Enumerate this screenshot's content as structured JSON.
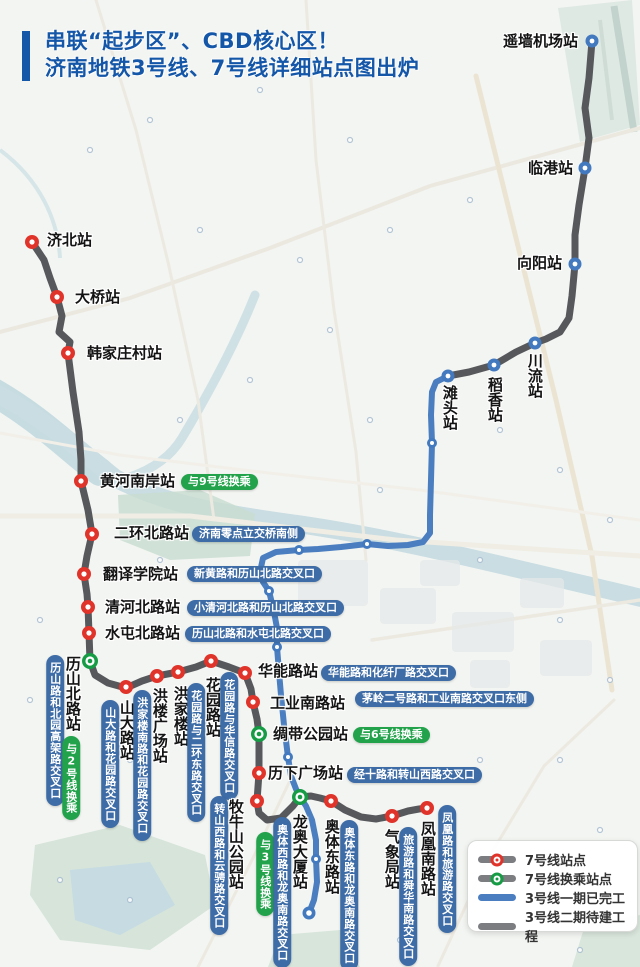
{
  "title": {
    "line1": "串联“起步区”、CBD核心区！",
    "line2": "济南地铁3号线、7号线详细站点图出炉"
  },
  "colors": {
    "title_blue": "#1456A8",
    "badge_blue": "#3E6CA6",
    "badge_green": "#22A24B",
    "line_gray": "#57585C",
    "legend_gray": "#7B7D80",
    "line_blue": "#4A7EC0",
    "dot_red": "#E0342B",
    "dot_green": "#169C44",
    "dot_blue": "#4379BE"
  },
  "legend": {
    "items": [
      {
        "label": "7号线站点",
        "symbol": "line7-station"
      },
      {
        "label": "7号线换乘站点",
        "symbol": "line7-transfer"
      },
      {
        "label": "3号线一期已完工",
        "symbol": "line3-built"
      },
      {
        "label": "3号线二期待建工程",
        "symbol": "line3-planned"
      }
    ]
  },
  "lines": [
    {
      "id": "line3-planned",
      "color": "line_gray",
      "width": 7,
      "points": "592,41 589,78 585,108 589,138 585,168 579,205 575,235 575,264 572,296 569,318 560,332 546,339 535,343 516,352 494,365 469,372 448,376"
    },
    {
      "id": "line3-built",
      "color": "line_blue",
      "width": 6,
      "points": "448,376 436,382 432,392 431,415 432,443 431,480 430,515 430,533 423,542 408,545 388,546 367,544 341,547 318,549 299,550 276,552 263,558 260,572 263,582 269,591 274,612 277,628 277,647 279,672 281,695 284,725 288,757 291,776 296,789 300,797 306,806 312,820 316,840 316,859 317,882 314,900 309,913"
    },
    {
      "id": "line7",
      "color": "line_gray",
      "width": 7,
      "points": "32,242 44,260 50,278 57,297 62,316 59,332 70,342 68,353 73,392 79,432 81,460 81,481 88,510 92,534 87,556 84,574 87,594 88,607 89,633 90,661 95,675 108,683 126,688 142,681 157,676 178,672 196,667 211,661 229,667 245,673 251,689 253,702 257,719 259,734 259,755 259,773 257,801 259,813 267,820 281,818 293,806 300,797 311,796 320,798 331,801 345,810 361,817 376,819 392,816 408,811 419,809 427,808"
    }
  ],
  "dots": [
    {
      "x": 32,
      "y": 242,
      "s": "r"
    },
    {
      "x": 57,
      "y": 297,
      "s": "r"
    },
    {
      "x": 68,
      "y": 353,
      "s": "r"
    },
    {
      "x": 81,
      "y": 481,
      "s": "r"
    },
    {
      "x": 92,
      "y": 534,
      "s": "r"
    },
    {
      "x": 84,
      "y": 574,
      "s": "r"
    },
    {
      "x": 88,
      "y": 607,
      "s": "r"
    },
    {
      "x": 89,
      "y": 633,
      "s": "r"
    },
    {
      "x": 126,
      "y": 687,
      "s": "r"
    },
    {
      "x": 157,
      "y": 676,
      "s": "r"
    },
    {
      "x": 178,
      "y": 672,
      "s": "r"
    },
    {
      "x": 211,
      "y": 661,
      "s": "r"
    },
    {
      "x": 245,
      "y": 673,
      "s": "r"
    },
    {
      "x": 253,
      "y": 702,
      "s": "r"
    },
    {
      "x": 259,
      "y": 773,
      "s": "r"
    },
    {
      "x": 257,
      "y": 801,
      "s": "r"
    },
    {
      "x": 331,
      "y": 801,
      "s": "r"
    },
    {
      "x": 392,
      "y": 816,
      "s": "r"
    },
    {
      "x": 427,
      "y": 808,
      "s": "r"
    },
    {
      "x": 90,
      "y": 661,
      "s": "g"
    },
    {
      "x": 259,
      "y": 734,
      "s": "g"
    },
    {
      "x": 300,
      "y": 797,
      "s": "g"
    },
    {
      "x": 592,
      "y": 41,
      "s": "b"
    },
    {
      "x": 585,
      "y": 168,
      "s": "b"
    },
    {
      "x": 575,
      "y": 264,
      "s": "b"
    },
    {
      "x": 535,
      "y": 343,
      "s": "b"
    },
    {
      "x": 494,
      "y": 365,
      "s": "b"
    },
    {
      "x": 448,
      "y": 376,
      "s": "b"
    },
    {
      "x": 432,
      "y": 443,
      "s": "bs"
    },
    {
      "x": 367,
      "y": 544,
      "s": "bs"
    },
    {
      "x": 299,
      "y": 550,
      "s": "bs"
    },
    {
      "x": 269,
      "y": 591,
      "s": "bs"
    },
    {
      "x": 277,
      "y": 647,
      "s": "bs"
    },
    {
      "x": 288,
      "y": 757,
      "s": "bs"
    },
    {
      "x": 316,
      "y": 859,
      "s": "bs"
    },
    {
      "x": 309,
      "y": 913,
      "s": "bt"
    }
  ],
  "texts": [
    {
      "t": "济北站",
      "k": "sh",
      "x": 47,
      "y": 233
    },
    {
      "t": "大桥站",
      "k": "sh",
      "x": 75,
      "y": 290
    },
    {
      "t": "韩家庄村站",
      "k": "sh",
      "x": 87,
      "y": 346
    },
    {
      "t": "黄河南岸站",
      "k": "sh",
      "x": 100,
      "y": 474
    },
    {
      "t": "与9号线换乘",
      "k": "gh",
      "x": 181,
      "y": 474
    },
    {
      "t": "二环北路站",
      "k": "sh",
      "x": 114,
      "y": 526
    },
    {
      "t": "济南零点立交桥南侧",
      "k": "bh",
      "x": 192,
      "y": 526
    },
    {
      "t": "翻译学院站",
      "k": "sh",
      "x": 103,
      "y": 567
    },
    {
      "t": "新黄路和历山北路交叉口",
      "k": "bh",
      "x": 187,
      "y": 566
    },
    {
      "t": "清河北路站",
      "k": "sh",
      "x": 105,
      "y": 600
    },
    {
      "t": "小清河北路和历山北路交叉口",
      "k": "bh",
      "x": 187,
      "y": 600
    },
    {
      "t": "水屯北路站",
      "k": "sh",
      "x": 105,
      "y": 626
    },
    {
      "t": "历山北路和水屯北路交叉口",
      "k": "bh",
      "x": 185,
      "y": 626
    },
    {
      "t": "华能路站",
      "k": "sh",
      "x": 258,
      "y": 664
    },
    {
      "t": "华能路和化纤厂路交叉口",
      "k": "bh",
      "x": 321,
      "y": 665
    },
    {
      "t": "工业南路站",
      "k": "sh",
      "x": 270,
      "y": 696
    },
    {
      "t": "茅岭二号路和工业南路交叉口东侧",
      "k": "bh",
      "x": 355,
      "y": 691
    },
    {
      "t": "绸带公园站",
      "k": "sh",
      "x": 273,
      "y": 727
    },
    {
      "t": "与6号线换乘",
      "k": "gh",
      "x": 353,
      "y": 727
    },
    {
      "t": "历下广场站",
      "k": "sh",
      "x": 268,
      "y": 766
    },
    {
      "t": "经十路和转山西路交叉口",
      "k": "bh",
      "x": 347,
      "y": 767
    },
    {
      "t": "遥墙机场站",
      "k": "sh",
      "x": 503,
      "y": 34
    },
    {
      "t": "临港站",
      "k": "sh",
      "x": 528,
      "y": 161
    },
    {
      "t": "向阳站",
      "k": "sh",
      "x": 517,
      "y": 256
    },
    {
      "t": "川流站",
      "k": "sv",
      "x": 534,
      "y": 353
    },
    {
      "t": "稻香站",
      "k": "sv",
      "x": 494,
      "y": 377
    },
    {
      "t": "滩头站",
      "k": "sv",
      "x": 449,
      "y": 385
    },
    {
      "t": "历山路和北园高架路交叉口",
      "k": "bv",
      "x": 55,
      "y": 655
    },
    {
      "t": "历山北路站",
      "k": "sv",
      "x": 72,
      "y": 656
    },
    {
      "t": "与2号线换乘",
      "k": "gv",
      "x": 71,
      "y": 736
    },
    {
      "t": "山大路和花园路交叉口",
      "k": "bv",
      "x": 110,
      "y": 700
    },
    {
      "t": "山大路站",
      "k": "sv",
      "x": 126,
      "y": 700
    },
    {
      "t": "洪家楼南路和花园路交叉口",
      "k": "bv",
      "x": 142,
      "y": 690
    },
    {
      "t": "洪楼广场站",
      "k": "sv",
      "x": 159,
      "y": 688
    },
    {
      "t": "洪家楼站",
      "k": "sv",
      "x": 180,
      "y": 686
    },
    {
      "t": "花园路与二环东路交叉口",
      "k": "bv",
      "x": 196,
      "y": 683
    },
    {
      "t": "花园路站",
      "k": "sv",
      "x": 212,
      "y": 677
    },
    {
      "t": "花园路与华信路交叉口",
      "k": "bv",
      "x": 229,
      "y": 672
    },
    {
      "t": "转山西路和云骋路交叉口",
      "k": "bv",
      "x": 219,
      "y": 796
    },
    {
      "t": "牧牛山公园站",
      "k": "sv",
      "x": 235,
      "y": 799
    },
    {
      "t": "与3号线换乘",
      "k": "gv",
      "x": 265,
      "y": 832
    },
    {
      "t": "奥体西路和龙奥南路交叉口",
      "k": "bv",
      "x": 282,
      "y": 817
    },
    {
      "t": "龙奥大厦站",
      "k": "sv",
      "x": 299,
      "y": 814
    },
    {
      "t": "奥体东路站",
      "k": "sv",
      "x": 331,
      "y": 819
    },
    {
      "t": "奥体东路和龙奥南路交叉口",
      "k": "bv",
      "x": 349,
      "y": 820
    },
    {
      "t": "气象局站",
      "k": "sv",
      "x": 391,
      "y": 829
    },
    {
      "t": "旅游路和舜华南路交叉口",
      "k": "bv",
      "x": 408,
      "y": 827
    },
    {
      "t": "凤凰南路站",
      "k": "sv",
      "x": 427,
      "y": 821
    },
    {
      "t": "凤凰路和旅游路交叉口",
      "k": "bv",
      "x": 447,
      "y": 805
    }
  ]
}
